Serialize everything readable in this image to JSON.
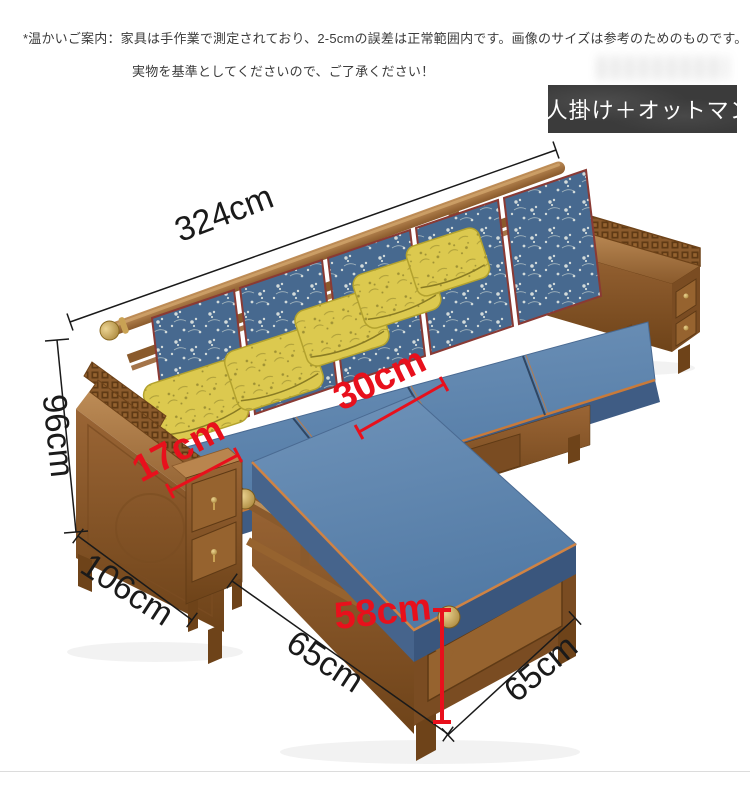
{
  "header": {
    "disclaimer_line1": "*温かいご案内：家具は手作業で測定されており、2-5cmの誤差は正常範囲内です。画像のサイズは参考のためのものです。",
    "disclaimer_line2": "実物を基準としてくださいので、ご了承ください！"
  },
  "badge": {
    "label": "5人掛け＋オットマン"
  },
  "annotations": {
    "total_width": {
      "label": "324cm",
      "color": "#1a1a1a"
    },
    "back_height": {
      "label": "96cm",
      "color": "#1a1a1a"
    },
    "side_depth": {
      "label": "106cm",
      "color": "#1a1a1a"
    },
    "armrest_width": {
      "label": "17cm",
      "color": "#e8101c"
    },
    "seat_depth": {
      "label": "30cm",
      "color": "#e8101c"
    },
    "ottoman_height": {
      "label": "58cm",
      "color": "#e8101c"
    },
    "ottoman_length": {
      "label": "65cm",
      "color": "#1a1a1a"
    },
    "ottoman_width": {
      "label": "65cm",
      "color": "#1a1a1a"
    }
  },
  "palette": {
    "background": "#ffffff",
    "accent_red": "#e8101c",
    "dimension_black": "#1a1a1a",
    "badge_bg": "#3b3b3b",
    "badge_text": "#ffffff",
    "wood_light": "#b9854e",
    "wood_mid": "#9a6535",
    "wood_dark": "#6e4319",
    "cushion_blue": "#5b80a9",
    "cushion_blue_dark": "#3f5c84",
    "pillow_yellow": "#dcc94f",
    "piping_orange": "#c87a3a",
    "brass": "#c9a254"
  }
}
